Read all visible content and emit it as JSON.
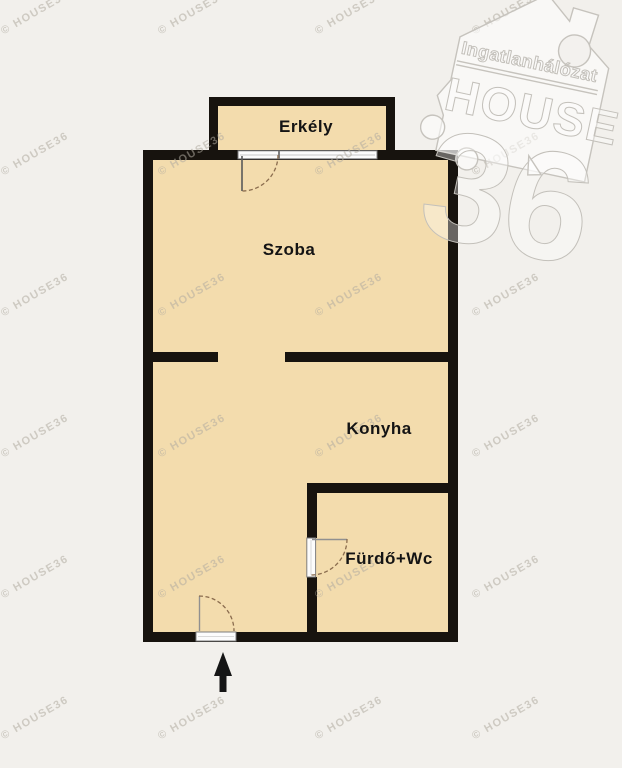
{
  "rooms": {
    "balcony": "Erkély",
    "room": "Szoba",
    "kitchen": "Konyha",
    "bathroom": "Fürdő+Wc"
  },
  "logo": {
    "line1": "Ingatlanhálózat",
    "line2": "HOUSE",
    "line3": "36"
  },
  "watermark": {
    "text": "© HOUSE36"
  },
  "colors": {
    "background": "#f2f0ec",
    "floor": "#f3dcad",
    "wall": "#17130e",
    "watermark_gray": "#c3c0ba"
  },
  "entrance": {
    "direction": "up"
  }
}
